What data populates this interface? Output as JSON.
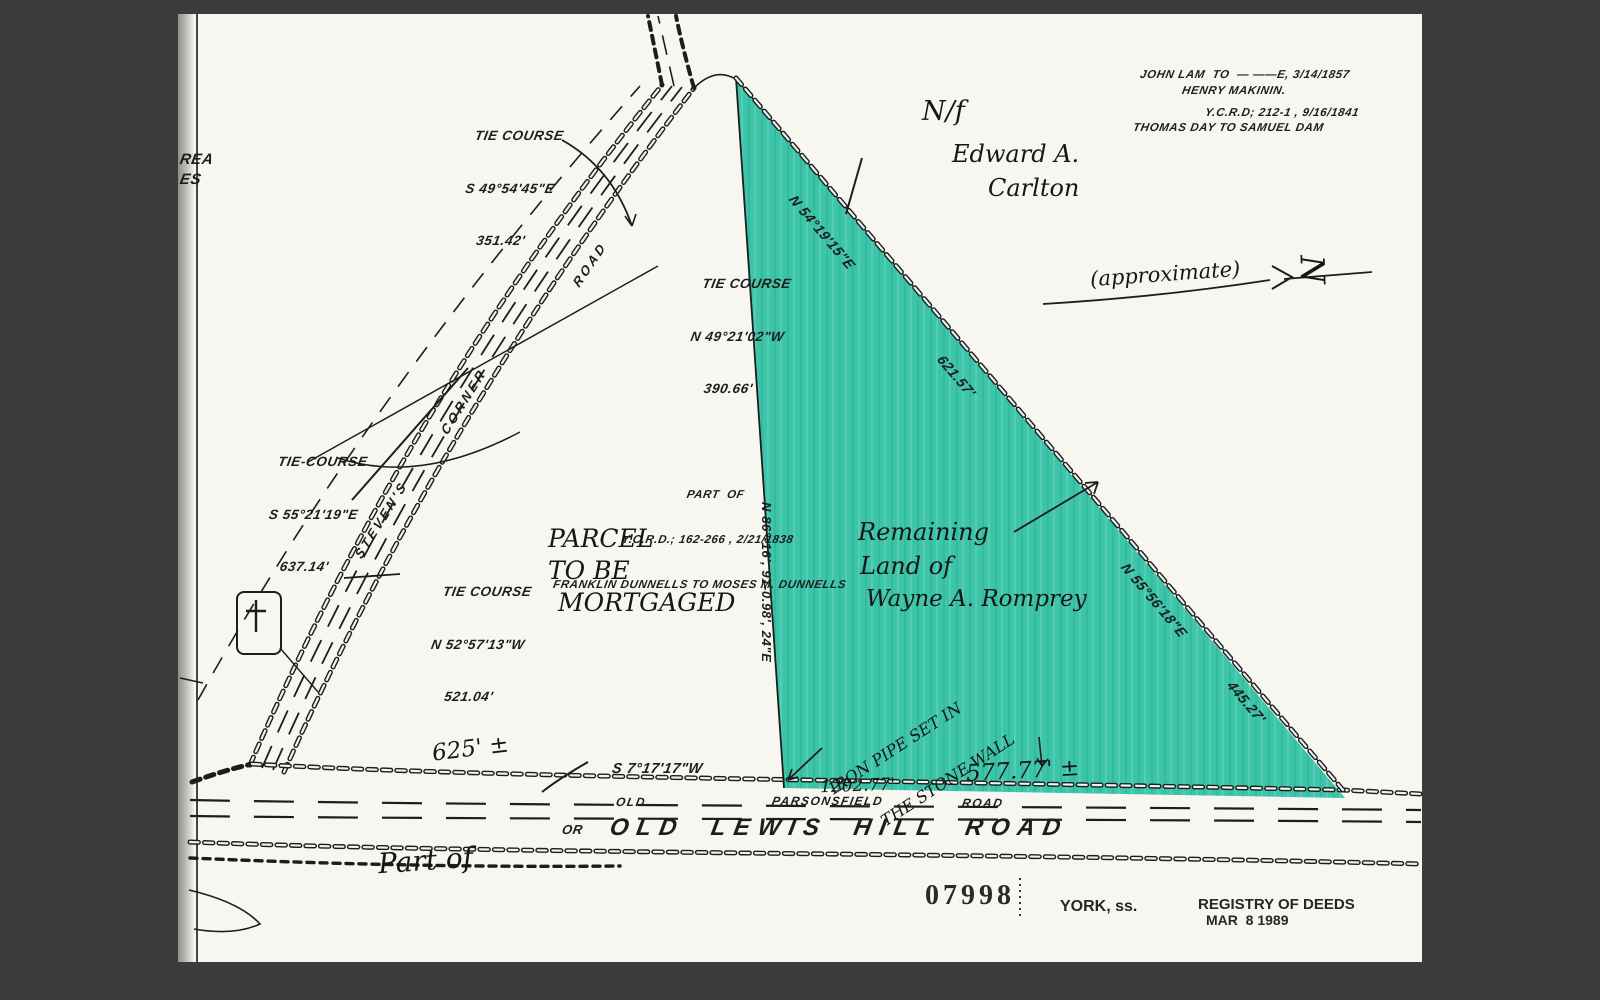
{
  "scene": {
    "background": "#3b3b3b",
    "paper": "#f7f6f1",
    "highlight": "#3cc5a9",
    "ink": "#1d1d1d"
  },
  "edge_fragments": {
    "line1": "REA",
    "line2": "ES"
  },
  "tie_course_1": {
    "title": "TIE COURSE",
    "bearing": "S 49°54'45\"E",
    "distance": "351.42'"
  },
  "tie_course_2": {
    "title": "TIE COURSE",
    "bearing": "N 49°21'02\"W",
    "distance": "390.66'"
  },
  "tie_course_3": {
    "title": "TIE-COURSE",
    "bearing": "S 55°21'19\"E",
    "distance": "637.14'"
  },
  "tie_course_4": {
    "title": "TIE COURSE",
    "bearing": "N 52°57'13\"W",
    "distance": "521.04'"
  },
  "abutter_note": {
    "line1": "N/f",
    "line2": "Edward A.",
    "line3": "Carlton"
  },
  "deed_note_1": {
    "line1": "JOHN LAM  TO  — ——E, 3/14/1857",
    "line2": "HENRY MAKININ."
  },
  "deed_note_2": {
    "line1": "Y.C.R.D; 212-1 , 9/16/1841",
    "line2": "THOMAS DAY TO SAMUEL DAM"
  },
  "north_arrow": {
    "label": "(approximate)",
    "letter": "N"
  },
  "source_deed": {
    "line1": "PART  OF",
    "line2": "Y.C.R.D.; 162-266 , 2/21/1838",
    "line3": "FRANKLIN DUNNELLS TO MOSES M. DUNNELLS"
  },
  "parcel_label": {
    "line1": "PARCEL",
    "line2": "TO BE",
    "line3": "MORTGAGED"
  },
  "remaining_label": {
    "line1": "Remaining",
    "line2": "Land of",
    "line3": "Wayne A. Romprey"
  },
  "steven_road": {
    "word1": "STEVEN'S",
    "word2": "CORNER",
    "word3": "ROAD"
  },
  "center_line_label": "N 86°-16', 91-0.98', 24\"E",
  "hypotenuse": {
    "bearing_upper": "N 54°19'15\"E",
    "distance_upper": "621.57'",
    "bearing_lower": "N 55°56'18\"E",
    "distance_lower": "445.27'"
  },
  "bottom_line": {
    "distance_left": "625' ±",
    "bearing": "S 7°17'17\"W",
    "distance_mid": "1202.77'",
    "distance_right": "577.77' ±",
    "monument_line1": "IRON PIPE SET IN",
    "monument_line2": "THE STONE WALL"
  },
  "bottom_road": {
    "alt1_word1": "OLD",
    "alt1_word2": "PARSONSFIELD",
    "alt1_word3": "ROAD",
    "or": "OR",
    "alt2": "OLD LEWIS HILL ROAD"
  },
  "part_of": "Part of",
  "stamps": {
    "plan_number": "07998",
    "county": "YORK, ss.",
    "registry_line1": "REGISTRY OF DEEDS",
    "registry_line2": "MAR  8 1989"
  }
}
